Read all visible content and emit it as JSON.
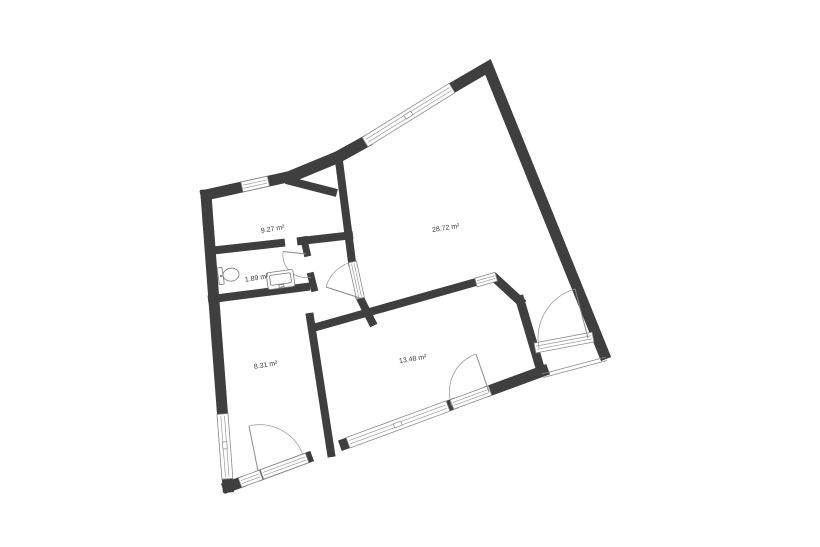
{
  "plan": {
    "title": "apartment-floor-plan",
    "rooms": [
      {
        "id": "room-top-left",
        "area_label": "9.27 m²"
      },
      {
        "id": "living-room",
        "area_label": "28.72 m²"
      },
      {
        "id": "bathroom",
        "area_label": "1.89 m²"
      },
      {
        "id": "room-bottom-left",
        "area_label": "8.31 m²"
      },
      {
        "id": "room-bottom-mid",
        "area_label": "13.48 m²"
      }
    ],
    "colors": {
      "wall": "#3f3f3f",
      "thin_line": "#9a9a9a",
      "fixture_line": "#777777",
      "label_text": "#3b3b3b",
      "background": "#ffffff"
    },
    "fixtures": [
      "toilet",
      "sink"
    ],
    "features": [
      "windows",
      "door-swings",
      "balcony-railing"
    ]
  }
}
